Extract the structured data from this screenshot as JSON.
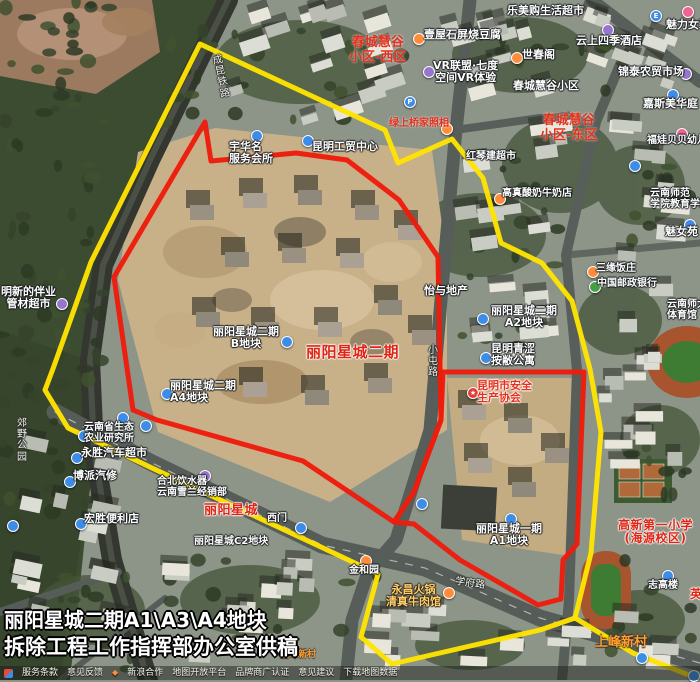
{
  "title": {
    "line1": "丽阳星城二期A1\\A3\\A4地块",
    "line2": "拆除工程工作指挥部办公室供稿"
  },
  "footer": {
    "links": [
      "服务条款",
      "意见反馈",
      "新浪合作",
      "地图开放平台",
      "品牌商广认证",
      "意见建议",
      "下载地图数据"
    ]
  },
  "colors": {
    "boundary_yellow": "#ffe400",
    "boundary_red": "#ee1c0c",
    "blue": "#3d8de8",
    "orange": "#ff8c3a",
    "purple": "#9575cd",
    "pink": "#f06292",
    "green": "#43a047",
    "red": "#e53935"
  },
  "map": {
    "labels": [
      {
        "name": "district-label-huigu-west",
        "text": "春城慧谷\n小区-西区",
        "x": 349,
        "y": 36,
        "size": 13,
        "cls": "ra",
        "center": true
      },
      {
        "name": "poi-label-tofu",
        "text": "壹屋石屏烧豆腐",
        "x": 424,
        "y": 29,
        "size": 11,
        "cls": "wo",
        "inter": true
      },
      {
        "name": "poi-label-vr",
        "text": "VR联盟·七度\n空间VR体验",
        "x": 433,
        "y": 60,
        "size": 11,
        "cls": "wo",
        "inter": true,
        "center": true
      },
      {
        "name": "poi-label-shichunge",
        "text": "世春阁",
        "x": 522,
        "y": 49,
        "size": 11,
        "cls": "wo",
        "inter": true
      },
      {
        "name": "poi-label-supermarket",
        "text": "乐美购生活超市",
        "x": 507,
        "y": 5,
        "size": 11,
        "cls": "wo",
        "inter": true
      },
      {
        "name": "poi-label-meili",
        "text": "魅力女装",
        "x": 666,
        "y": 19,
        "size": 11,
        "cls": "wo",
        "inter": true
      },
      {
        "name": "poi-label-hotel",
        "text": "云上四季酒店",
        "x": 576,
        "y": 35,
        "size": 11,
        "cls": "wo",
        "inter": true
      },
      {
        "name": "district-label-huigu",
        "text": "春城慧谷小区",
        "x": 513,
        "y": 80,
        "size": 11,
        "cls": "wo"
      },
      {
        "name": "poi-label-market",
        "text": "锦泰农贸市场",
        "x": 618,
        "y": 66,
        "size": 11,
        "cls": "wo",
        "inter": true
      },
      {
        "name": "poi-label-jiasi",
        "text": "嘉斯美华庭",
        "x": 643,
        "y": 98,
        "size": 11,
        "cls": "wo",
        "inter": true
      },
      {
        "name": "district-label-huigu-east",
        "text": "春城慧谷\n小区-东区",
        "x": 540,
        "y": 114,
        "size": 13,
        "cls": "ra",
        "center": true
      },
      {
        "name": "poi-label-hongqin",
        "text": "红琴建超市",
        "x": 466,
        "y": 151,
        "size": 10,
        "cls": "wo",
        "inter": true
      },
      {
        "name": "poi-label-kindergarten",
        "text": "福娃贝贝幼儿园",
        "x": 647,
        "y": 135,
        "size": 10,
        "cls": "wo",
        "inter": true
      },
      {
        "name": "poi-label-milk",
        "text": "高真酸奶牛奶店",
        "x": 502,
        "y": 188,
        "size": 10,
        "cls": "wo",
        "inter": true
      },
      {
        "name": "poi-label-normal-college",
        "text": "云南师范\n学院教育学院",
        "x": 650,
        "y": 188,
        "size": 10,
        "cls": "wo"
      },
      {
        "name": "poi-label-meinvyuan",
        "text": "魅女苑",
        "x": 665,
        "y": 226,
        "size": 11,
        "cls": "wo",
        "inter": true
      },
      {
        "name": "poi-label-restaurant",
        "text": "三缘饭庄",
        "x": 596,
        "y": 263,
        "size": 10,
        "cls": "wo",
        "inter": true
      },
      {
        "name": "poi-label-post-bank",
        "text": "中国邮政银行",
        "x": 597,
        "y": 278,
        "size": 10,
        "cls": "wo",
        "inter": true
      },
      {
        "name": "poi-label-yiyu",
        "text": "怡与地产",
        "x": 424,
        "y": 285,
        "size": 11,
        "cls": "wo",
        "inter": true
      },
      {
        "name": "poi-label-a2",
        "text": "丽阳星城二期\nA2地块",
        "x": 491,
        "y": 305,
        "size": 11,
        "cls": "wo",
        "inter": true,
        "center": true
      },
      {
        "name": "poi-label-apartment",
        "text": "昆明青涩\n按敝公寓",
        "x": 491,
        "y": 343,
        "size": 11,
        "cls": "wo",
        "inter": true
      },
      {
        "name": "poi-label-safety-assoc",
        "text": "昆明市安全\n生产协会",
        "x": 477,
        "y": 380,
        "size": 11,
        "cls": "rp",
        "inter": true
      },
      {
        "name": "district-label-liyang-phase2",
        "text": "丽阳星城二期",
        "x": 306,
        "y": 344,
        "size": 15,
        "cls": "rb"
      },
      {
        "name": "poi-label-b-block",
        "text": "丽阳星城二期\nB地块",
        "x": 213,
        "y": 326,
        "size": 11,
        "cls": "wo",
        "inter": true,
        "center": true
      },
      {
        "name": "poi-label-a4",
        "text": "丽阳星城二期\nA4地块",
        "x": 170,
        "y": 380,
        "size": 11,
        "cls": "wo",
        "inter": true
      },
      {
        "name": "road-label-xiaotun",
        "text": "小\n屯\n路",
        "x": 428,
        "y": 345,
        "size": 10,
        "cls": "rd"
      },
      {
        "name": "poi-label-pipe-store",
        "text": "明新的伴业\n管材超市",
        "x": 1,
        "y": 286,
        "size": 11,
        "cls": "wo",
        "inter": true,
        "center": true
      },
      {
        "name": "rail-label",
        "text": "成\n昆\n铁\n路",
        "x": 212,
        "y": 56,
        "size": 10,
        "cls": "rd",
        "rotate": -12
      },
      {
        "name": "park-label",
        "text": "郊\n野\n公\n园",
        "x": 17,
        "y": 418,
        "size": 10,
        "cls": "rd"
      },
      {
        "name": "poi-label-eco-institute",
        "text": "云南省生态\n农业研究所",
        "x": 84,
        "y": 422,
        "size": 10,
        "cls": "wo",
        "inter": true
      },
      {
        "name": "poi-label-auto-market",
        "text": "永胜汽车超市",
        "x": 81,
        "y": 447,
        "size": 11,
        "cls": "wo",
        "inter": true
      },
      {
        "name": "poi-label-repair",
        "text": "博派汽修",
        "x": 73,
        "y": 470,
        "size": 11,
        "cls": "wo",
        "inter": true
      },
      {
        "name": "poi-label-store",
        "text": "宏胜便利店",
        "x": 84,
        "y": 513,
        "size": 11,
        "cls": "wo",
        "inter": true
      },
      {
        "name": "poi-label-club",
        "text": "宇华名\n服务会所",
        "x": 229,
        "y": 141,
        "size": 11,
        "cls": "wo",
        "inter": true
      },
      {
        "name": "poi-label-gongmao",
        "text": "昆明工贸中心",
        "x": 312,
        "y": 141,
        "size": 11,
        "cls": "wo"
      },
      {
        "name": "poi-label-photo",
        "text": "绿上桥家照相",
        "x": 389,
        "y": 118,
        "size": 10,
        "cls": "ra",
        "inter": true
      },
      {
        "name": "poi-label-water",
        "text": "合北饮水器\n云南雪兰经销部",
        "x": 157,
        "y": 476,
        "size": 10,
        "cls": "wo",
        "inter": true
      },
      {
        "name": "district-label-liyang",
        "text": "丽阳星城",
        "x": 204,
        "y": 504,
        "size": 13,
        "cls": "rb"
      },
      {
        "name": "poi-label-west-gate",
        "text": "西门",
        "x": 267,
        "y": 513,
        "size": 10,
        "cls": "wo"
      },
      {
        "name": "poi-label-c2",
        "text": "丽阳星城C2地块",
        "x": 194,
        "y": 536,
        "size": 10,
        "cls": "wo"
      },
      {
        "name": "poi-label-jinheyuan",
        "text": "金和园",
        "x": 349,
        "y": 565,
        "size": 10,
        "cls": "wo",
        "inter": true
      },
      {
        "name": "poi-label-hotpot",
        "text": "永昌火锅\n清真牛肉馆",
        "x": 386,
        "y": 584,
        "size": 11,
        "cls": "op",
        "inter": true,
        "center": true
      },
      {
        "name": "poi-label-a1",
        "text": "丽阳星城一期\nA1地块",
        "x": 476,
        "y": 523,
        "size": 11,
        "cls": "wo",
        "inter": true,
        "center": true
      },
      {
        "name": "road-label-xuefu",
        "text": "学府路",
        "x": 456,
        "y": 576,
        "size": 10,
        "cls": "rd",
        "rotate": 8
      },
      {
        "name": "village-label-small",
        "text": "上峰新村",
        "x": 280,
        "y": 650,
        "size": 9,
        "cls": "oa"
      },
      {
        "name": "village-label",
        "text": "上峰新村",
        "x": 595,
        "y": 636,
        "size": 13,
        "cls": "oa"
      },
      {
        "name": "poi-label-zhigaolou",
        "text": "志高楼",
        "x": 648,
        "y": 580,
        "size": 10,
        "cls": "wo",
        "inter": true
      },
      {
        "name": "poi-label-clipped",
        "text": "英",
        "x": 690,
        "y": 588,
        "size": 12,
        "cls": "rb"
      },
      {
        "name": "school-label",
        "text": "高新第一小学\n(海源校区)",
        "x": 618,
        "y": 519,
        "size": 12,
        "cls": "rb",
        "center": true
      },
      {
        "name": "stadium-label",
        "text": "云南师大\n体育馆",
        "x": 667,
        "y": 299,
        "size": 10,
        "cls": "wo"
      }
    ],
    "markers": [
      {
        "name": "poi-icon-food",
        "color": "orange",
        "x": 413,
        "y": 33
      },
      {
        "name": "poi-icon-vr",
        "color": "purple",
        "x": 423,
        "y": 66
      },
      {
        "name": "poi-icon-shichunge",
        "color": "orange",
        "x": 511,
        "y": 52
      },
      {
        "name": "poi-icon-hotel",
        "color": "purple",
        "x": 602,
        "y": 24
      },
      {
        "name": "poi-icon-market",
        "color": "purple",
        "x": 680,
        "y": 68
      },
      {
        "name": "poi-icon",
        "color": "blue",
        "x": 650,
        "y": 10,
        "glyph": "E"
      },
      {
        "name": "poi-icon",
        "color": "pink",
        "x": 682,
        "y": 6
      },
      {
        "name": "poi-icon",
        "color": "blue",
        "x": 667,
        "y": 89
      },
      {
        "name": "poi-icon-kindergarten",
        "color": "pink",
        "x": 676,
        "y": 128
      },
      {
        "name": "parking-icon",
        "color": "blue",
        "x": 404,
        "y": 96,
        "glyph": "P"
      },
      {
        "name": "poi-icon-milk",
        "color": "orange",
        "x": 494,
        "y": 193
      },
      {
        "name": "bus-stop-icon",
        "color": "blue",
        "x": 629,
        "y": 160
      },
      {
        "name": "poi-icon",
        "color": "blue",
        "x": 684,
        "y": 219
      },
      {
        "name": "poi-icon-restaurant",
        "color": "orange",
        "x": 587,
        "y": 266
      },
      {
        "name": "poi-icon-bank",
        "color": "green",
        "x": 589,
        "y": 281
      },
      {
        "name": "poi-icon-a2",
        "color": "blue",
        "x": 477,
        "y": 313
      },
      {
        "name": "poi-icon-apartment",
        "color": "blue",
        "x": 480,
        "y": 352
      },
      {
        "name": "safety-association-icon",
        "color": "red",
        "x": 467,
        "y": 387,
        "glyph": "★"
      },
      {
        "name": "poi-icon-b-block",
        "color": "blue",
        "x": 281,
        "y": 336
      },
      {
        "name": "poi-icon-a4",
        "color": "blue",
        "x": 161,
        "y": 388
      },
      {
        "name": "poi-icon",
        "color": "purple",
        "x": 56,
        "y": 298
      },
      {
        "name": "poi-icon-research",
        "color": "blue",
        "x": 78,
        "y": 430
      },
      {
        "name": "poi-icon-auto",
        "color": "blue",
        "x": 71,
        "y": 452
      },
      {
        "name": "poi-icon-repair",
        "color": "blue",
        "x": 64,
        "y": 476
      },
      {
        "name": "poi-icon-store",
        "color": "blue",
        "x": 75,
        "y": 518
      },
      {
        "name": "bus-stop-icon",
        "color": "blue",
        "x": 117,
        "y": 412
      },
      {
        "name": "poi-icon",
        "color": "blue",
        "x": 140,
        "y": 420
      },
      {
        "name": "poi-icon",
        "color": "blue",
        "x": 7,
        "y": 520
      },
      {
        "name": "poi-icon",
        "color": "blue",
        "x": 251,
        "y": 130
      },
      {
        "name": "poi-icon",
        "color": "blue",
        "x": 302,
        "y": 135
      },
      {
        "name": "poi-icon-photo",
        "color": "orange",
        "x": 441,
        "y": 123
      },
      {
        "name": "poi-icon-water",
        "color": "purple",
        "x": 199,
        "y": 470
      },
      {
        "name": "poi-icon",
        "color": "blue",
        "x": 295,
        "y": 522
      },
      {
        "name": "poi-icon-garden",
        "color": "orange",
        "x": 360,
        "y": 555
      },
      {
        "name": "poi-icon-hotpot",
        "color": "orange",
        "x": 443,
        "y": 587
      },
      {
        "name": "poi-icon",
        "color": "blue",
        "x": 416,
        "y": 498
      },
      {
        "name": "poi-icon-a1",
        "color": "blue",
        "x": 505,
        "y": 513
      },
      {
        "name": "poi-icon",
        "color": "blue",
        "x": 662,
        "y": 570
      },
      {
        "name": "poi-icon",
        "color": "blue",
        "x": 636,
        "y": 652
      },
      {
        "name": "poi-icon",
        "color": "blue",
        "x": 688,
        "y": 670
      },
      {
        "name": "metro-icon",
        "color": "blue",
        "x": 114,
        "y": 611
      }
    ]
  }
}
